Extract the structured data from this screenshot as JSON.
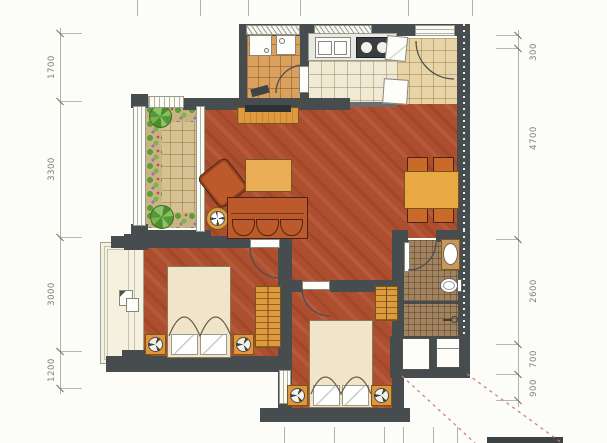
{
  "dims": {
    "left": [
      "1700",
      "3300",
      "3000",
      "1200"
    ],
    "right": [
      "300",
      "4700",
      "2600",
      "700",
      "900"
    ]
  },
  "colors": {
    "wall": "#474c4f",
    "wood_floor": "#ad4e2f",
    "furniture_wood": "#dd9a3f",
    "upholstery": "#bd5a2c",
    "balcony_tile": "#d6c193",
    "kitchen_tile": "#f0ead5",
    "entry_tile": "#e7d5a8",
    "utility_tile": "#d9a05e",
    "bath_tile": "#a2835f",
    "dimension_line": "#b3b3a1",
    "dimension_text": "#82827a",
    "leader_dashed": "#c97878"
  }
}
